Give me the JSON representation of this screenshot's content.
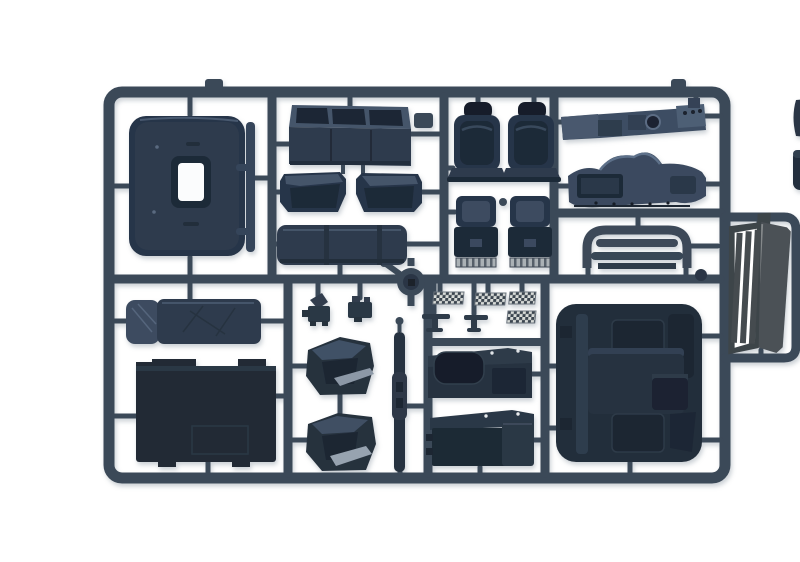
{
  "meta": {
    "title": "Plastic model kit sprue — truck cab interior parts",
    "description": "Photograph of a dark blue-grey injection-molded sprue (parts tree) on a white background, containing truck cab interior parts: rear cab panel with window, overhead shelf, engine covers, bunk mattress, seats and seat bases, dashboard halves, roof deflector, floor panels, door cards, sleeper sidewalls, pedal tread plates, levers, engine tunnel and a radiator grille on a side outrigger."
  },
  "palette": {
    "photo_background": "#ffffff",
    "runner": "#3b4858",
    "runner_dark": "#2b3645",
    "part": "#28344a",
    "part_mid": "#2e3b4d",
    "part_dark": "#1f2a38",
    "part_darker": "#151e29",
    "part_light": "#44546b",
    "part_lighter": "#5d7089",
    "silver": "#aab1b5",
    "checker_light": "#d8dbd8",
    "grille": "#4b5156",
    "grille_frame": "#3e444a",
    "shadow": "#8c98a3"
  },
  "parts": [
    {
      "id": "cab-back-panel",
      "desc": "cab rear wall with white window cutout and side bracket"
    },
    {
      "id": "overhead-shelf",
      "desc": "overhead storage shelf with three compartments"
    },
    {
      "id": "engine-cowl-left",
      "desc": "left engine cowl wedge"
    },
    {
      "id": "engine-cowl-right",
      "desc": "right engine cowl wedge"
    },
    {
      "id": "bench-cushion",
      "desc": "long bench cushion with straps"
    },
    {
      "id": "seat-back-left",
      "desc": "seat back with headrest"
    },
    {
      "id": "seat-back-right",
      "desc": "seat back with headrest"
    },
    {
      "id": "seat-base-left",
      "desc": "seat base box with striped sled pad"
    },
    {
      "id": "seat-base-right",
      "desc": "seat base box with striped sled pad"
    },
    {
      "id": "dashboard-upper",
      "desc": "upper dashboard rail with gauge hole"
    },
    {
      "id": "dashboard-lower",
      "desc": "lower sculpted dashboard"
    },
    {
      "id": "roof-deflector",
      "desc": "slatted roof deflector bridge"
    },
    {
      "id": "bunk-mattress",
      "desc": "sleeper bunk mattress with pillow"
    },
    {
      "id": "floor-panel",
      "desc": "large cab floor panel with notched edge"
    },
    {
      "id": "door-card-left",
      "desc": "door interior trim panel"
    },
    {
      "id": "door-card-right",
      "desc": "door interior trim panel"
    },
    {
      "id": "pillar-trim-strip",
      "desc": "long thin pillar trim strip"
    },
    {
      "id": "sleeper-sidewall-window",
      "desc": "sleeper sidewall with window recess"
    },
    {
      "id": "sleeper-sidewall-plain",
      "desc": "sleeper sidewall with end cap"
    },
    {
      "id": "pedal-bracket-left",
      "desc": "small pedal bracket"
    },
    {
      "id": "pedal-bracket-right",
      "desc": "small pedal bracket"
    },
    {
      "id": "tread-plates",
      "desc": "four checkered tread plates"
    },
    {
      "id": "shift-levers",
      "desc": "two T-shaped levers"
    },
    {
      "id": "engine-tunnel",
      "desc": "large engine tunnel floor unit"
    },
    {
      "id": "radiator-grille",
      "desc": "slatted radiator grille on outrigger"
    },
    {
      "id": "cropped-edge-parts",
      "desc": "parts cropped by right photo edge"
    }
  ]
}
